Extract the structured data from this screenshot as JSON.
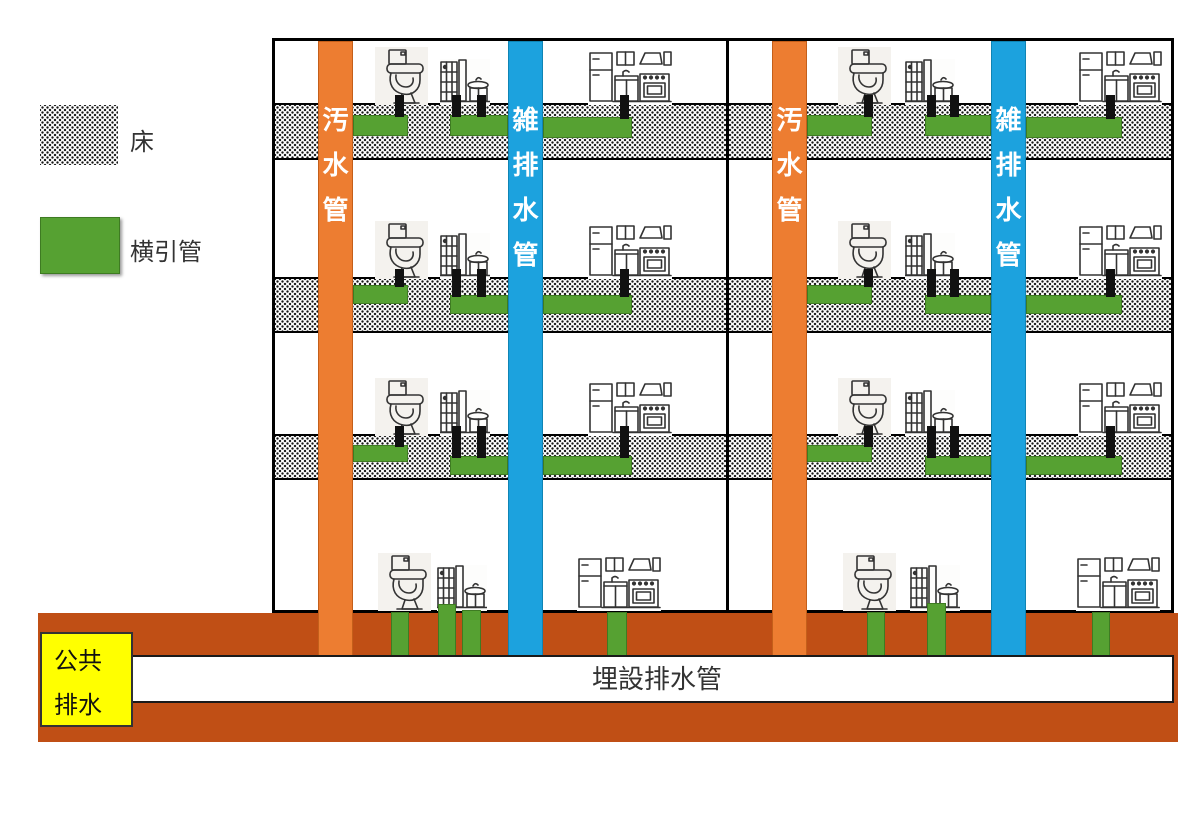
{
  "legend": {
    "floor_label": "床",
    "lateral_pipe_label": "横引管"
  },
  "pipes": {
    "soil_stack_label": "汚水管",
    "waste_stack_label": "雑排水管"
  },
  "ground": {
    "buried_pipe_label": "埋設排水管",
    "public_sewer_line1": "公共",
    "public_sewer_line2": "排水"
  },
  "colors": {
    "soil_pipe_orange": "#ED7D31",
    "waste_pipe_blue": "#1CA2DE",
    "lateral_pipe_green": "#56A132",
    "ground_soil_brown": "#C04F15",
    "public_sewer_yellow": "#FFFF00"
  },
  "icons": {
    "toilet": "toilet-icon",
    "shower_sink": "shower-sink-icon",
    "kitchen": "kitchen-icon"
  }
}
